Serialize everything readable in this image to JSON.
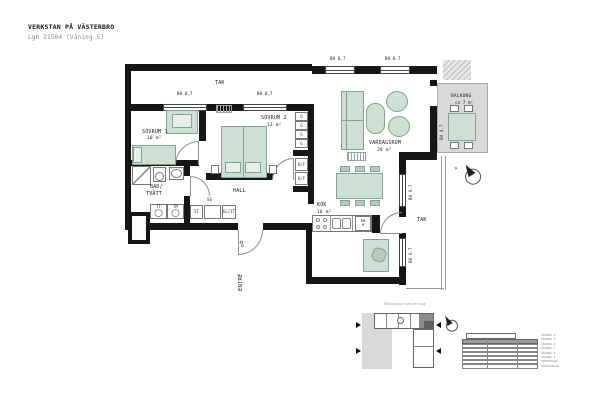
{
  "header": {
    "title": "VERKSTAN PÅ VÄSTERBRO",
    "subtitle": "Lgh 21504 (Våning 5)"
  },
  "rooms": {
    "sovrum1": {
      "name": "SOVRUM 1",
      "area": "10 m²"
    },
    "sovrum2": {
      "name": "SOVRUM 2",
      "area": "13 m²"
    },
    "bad": {
      "line1": "BAD/",
      "line2": "TVÄTT"
    },
    "hall": {
      "name": "HALL"
    },
    "kok": {
      "name": "KÖK",
      "area": "16 m²"
    },
    "vardagsrum": {
      "name": "VARDAGSRUM",
      "area": "20 m²"
    },
    "balkong": {
      "name": "BALKONG",
      "area": "ca 7 m²"
    },
    "tak": {
      "name": "TAK"
    },
    "entre": {
      "name": "ENTRÉ"
    }
  },
  "annotations": {
    "window_height": "BH 0.7",
    "north_letter": "N",
    "entre_arrow": "⇧"
  },
  "fixtures": {
    "wardrobe": "G",
    "fridge_freezer": "K/F",
    "dryer": "TT",
    "washer": "TM",
    "cleaning_closet": "ST",
    "sliding_wardrobe": "SG",
    "electrical": "EL/IT",
    "dishwasher": "DM",
    "microwave": "M"
  },
  "overview": {
    "caption": "Våningsorientering",
    "floors": [
      "VÅNING 6",
      "VÅNING 5",
      "VÅNING 4",
      "VÅNING 3",
      "VÅNING 2",
      "VÅNING 1",
      "ENTRÉPLAN",
      "GARAGEPLAN"
    ]
  },
  "colors": {
    "wall": "#161616",
    "furniture_fill": "#cedfd4",
    "balcony_fill": "#d9d9d9",
    "highlight_unit": "#8c8c8c"
  }
}
